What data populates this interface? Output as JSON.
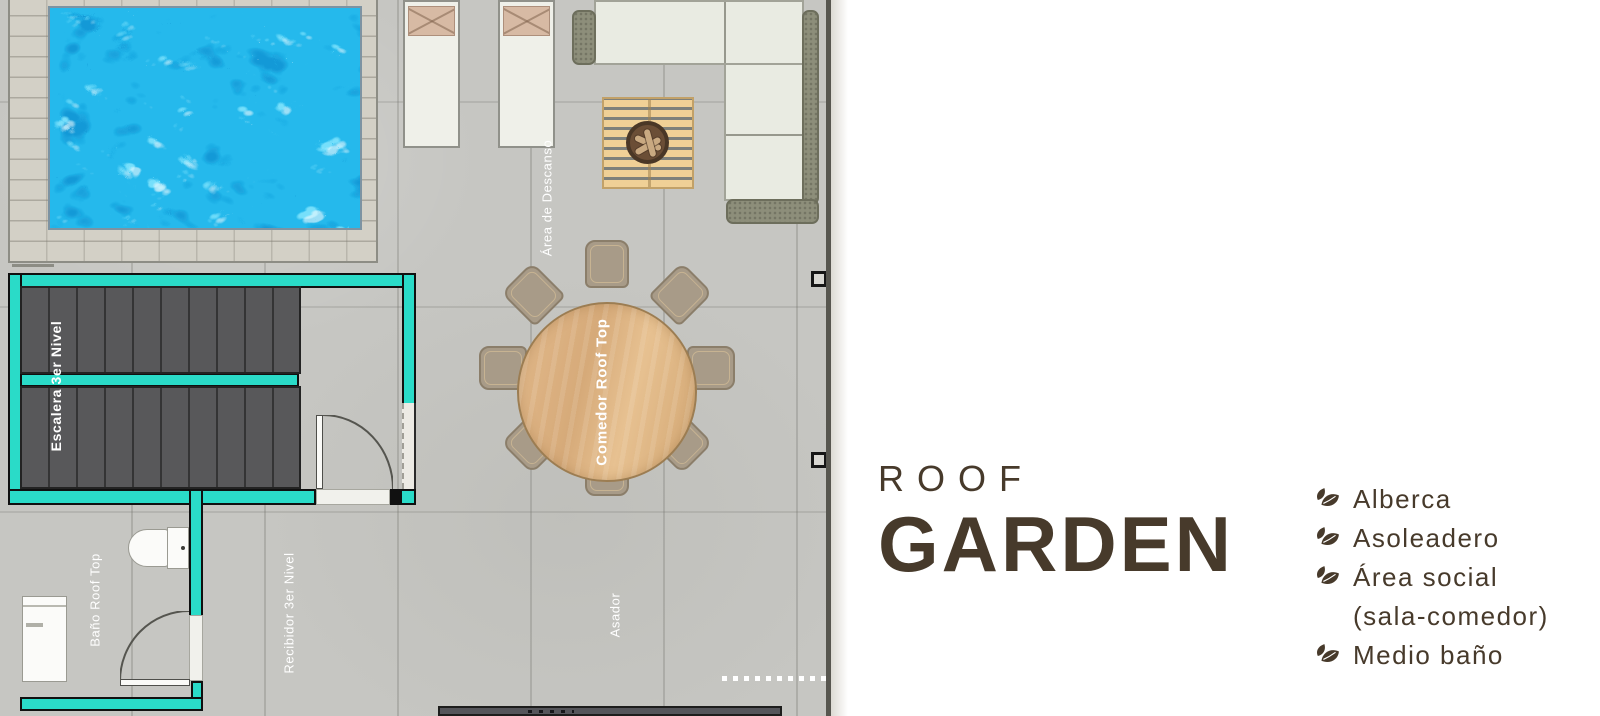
{
  "plan": {
    "labels": {
      "stairs": "Escalera 3er Nivel",
      "rest_area": "Área de Descanso",
      "dining": "Comedor Roof Top",
      "bathroom": "Baño Roof Top",
      "hall": "Recibidor 3er Nivel",
      "grill": "Asador"
    },
    "colors": {
      "wall_accent": "#2adbc8",
      "pool_water": "#25b9ec",
      "floor": "#c6c6c2",
      "stairs": "#58585a",
      "wood_table": "#d9ae7f"
    }
  },
  "panel": {
    "title_line1": "ROOF",
    "title_line2": "GARDEN",
    "title_color": "#473a2b",
    "features": [
      {
        "label": "Alberca"
      },
      {
        "label": "Asoleadero"
      },
      {
        "label": "Área social"
      },
      {
        "label": "(sala-comedor)"
      },
      {
        "label": "Medio baño"
      }
    ]
  }
}
